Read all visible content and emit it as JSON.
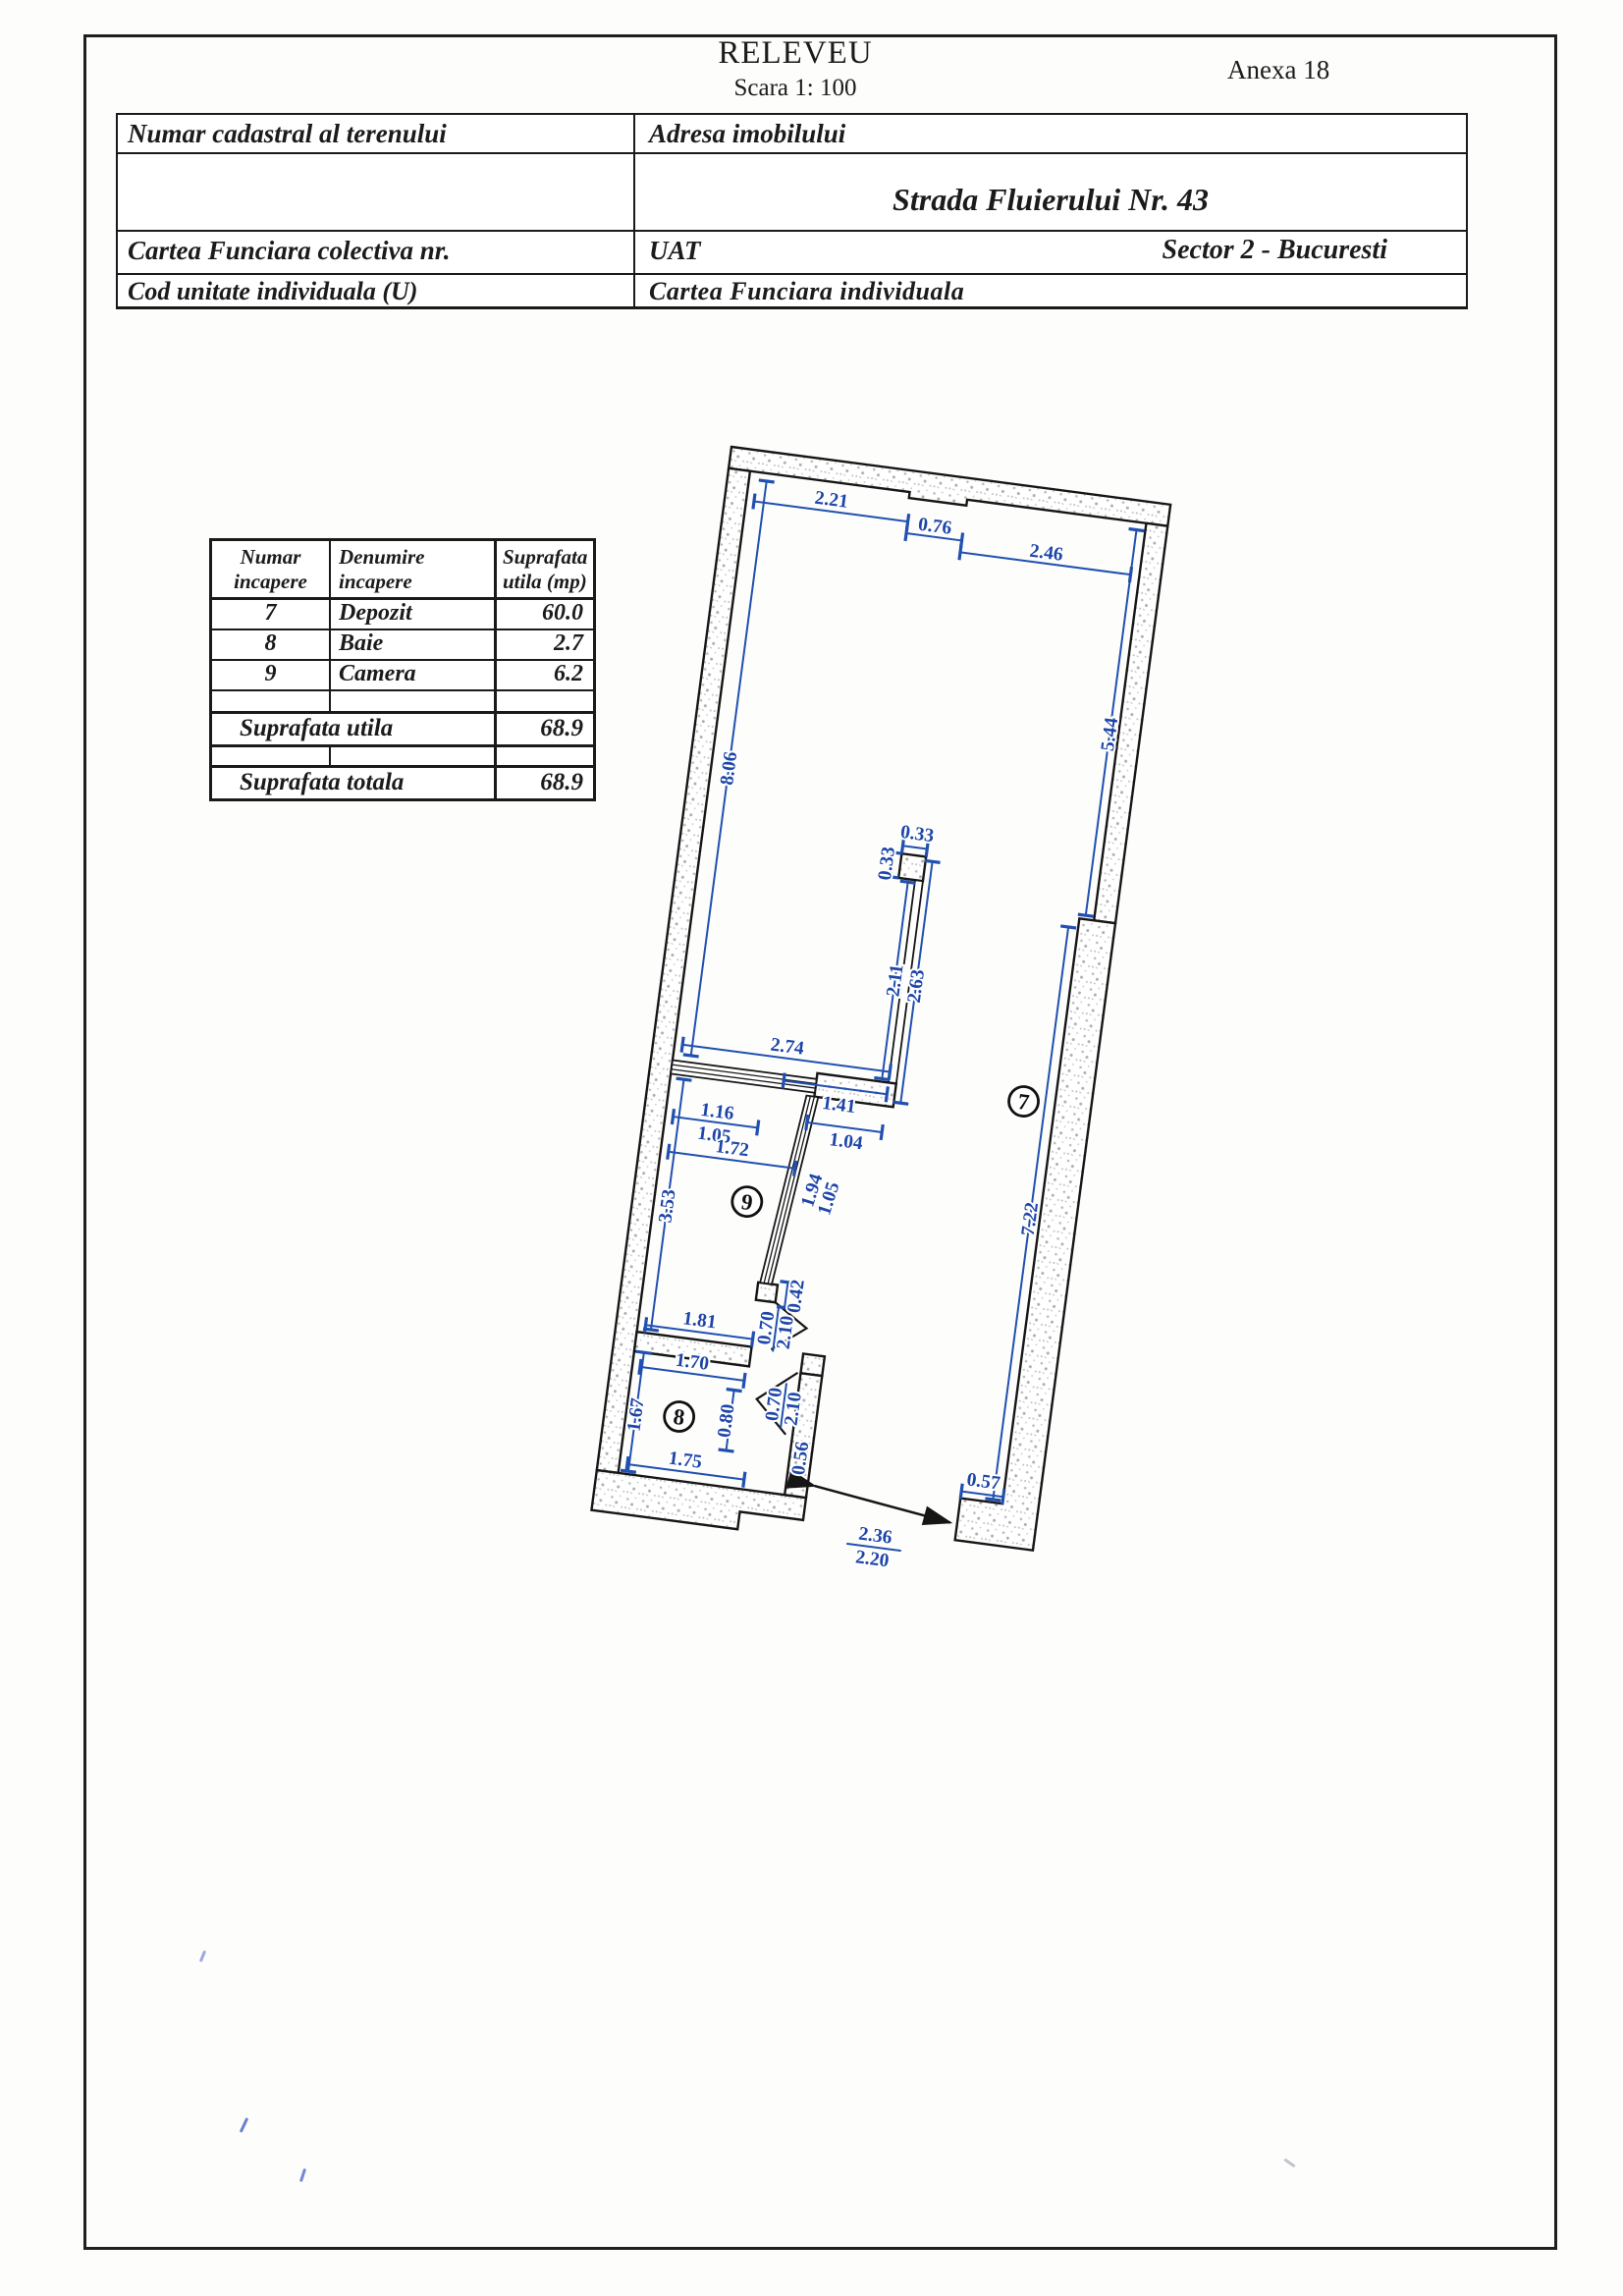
{
  "header": {
    "title": "RELEVEU",
    "scale": "Scara 1: 100",
    "annex": "Anexa 18"
  },
  "info_table": {
    "cadastral_label": "Numar cadastral al terenului",
    "address_label": "Adresa imobilului",
    "address_value": "Strada Fluierului Nr. 43",
    "colectiva_label": "Cartea Funciara colectiva nr.",
    "uat_label": "UAT",
    "sector_value": "Sector 2 - Bucuresti",
    "cod_label": "Cod unitate individuala (U)",
    "individuala_label": "Cartea Funciara individuala"
  },
  "room_table": {
    "headers": [
      {
        "l1": "Numar",
        "l2": "incapere"
      },
      {
        "l1": "Denumire",
        "l2": "incapere"
      },
      {
        "l1": "Suprafata",
        "l2": "utila (mp)"
      }
    ],
    "rows": [
      {
        "nr": "7",
        "name": "Depozit",
        "area": "60.0"
      },
      {
        "nr": "8",
        "name": "Baie",
        "area": "2.7"
      },
      {
        "nr": "9",
        "name": "Camera",
        "area": "6.2"
      }
    ],
    "utila_label": "Suprafata utila",
    "utila_value": "68.9",
    "totala_label": "Suprafata totala",
    "totala_value": "68.9"
  },
  "plan": {
    "room7": "7",
    "room8": "8",
    "room9": "9",
    "dims": {
      "top_a": "2.21",
      "top_b": "0.76",
      "top_c": "2.46",
      "left_h": "8.06",
      "right_h_upper": "5.44",
      "right_h_lower": "7.22",
      "niche_top": "0.33",
      "niche_side": "0.33",
      "flue_a": "2.11",
      "flue_b": "2.63",
      "hall_a": "2.74",
      "hall_b": "1.41",
      "pass": "1.04",
      "win_a": "1.16",
      "win_b": "1.05",
      "r9_w": "1.72",
      "r9_h": "3.53",
      "r9_bw": "1.81",
      "part_a": "1.94",
      "part_b": "1.05",
      "jamb9": "0.42",
      "door9_w": "0.70",
      "door9_h": "2.10",
      "r8_tw": "1.70",
      "r8_h": "1.67",
      "r8_bw": "1.75",
      "door8_w": "0.70",
      "door8_h": "2.10",
      "jamb8_a": "0.80",
      "jamb8_b": "0.56",
      "entry_a": "2.36",
      "entry_b": "2.20",
      "entry_step": "0.57"
    }
  }
}
